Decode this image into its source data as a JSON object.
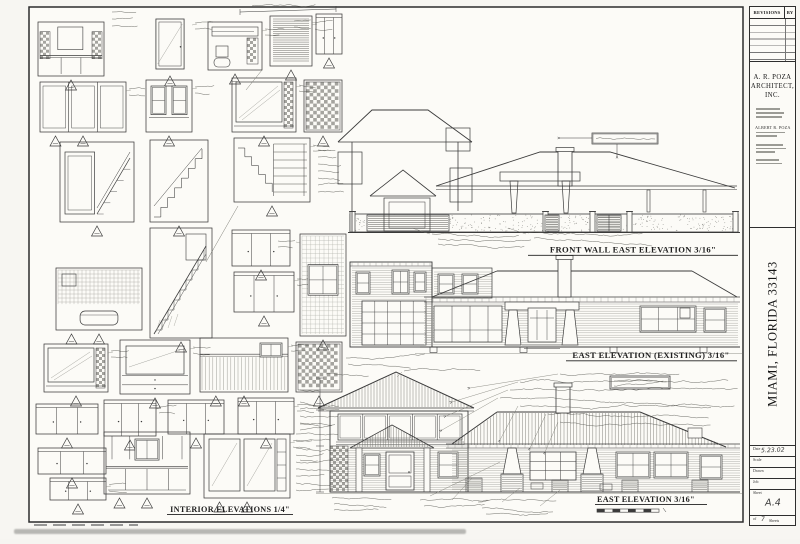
{
  "labels": {
    "front_wall_title": "FRONT WALL EAST ELEVATION 3/16\"",
    "east_existing_title": "EAST ELEVATION (EXISTING) 3/16\"",
    "east_new_title": "EAST ELEVATION 3/16\"",
    "interior_title": "INTERIOR ELEVATIONS 1/4\""
  },
  "title_block": {
    "revisions_label": "REVISIONS",
    "by_label": "BY",
    "firm_line1": "A. R. POZA",
    "firm_line2": "ARCHITECT, INC.",
    "principal": "ALBERT R. POZA",
    "location_vertical": "MIAMI, FLORIDA 33143",
    "date_label": "Date",
    "date_value": "5.23.02",
    "scale_label": "Scale",
    "drawn_label": "Drawn",
    "job_label": "Job",
    "sheet_label": "Sheet",
    "sheet_number": "A.4",
    "of_label": "of",
    "sheet_count": "7",
    "sheets_label": "Sheets"
  },
  "colors": {
    "ink": "#3b3b3b",
    "paper": "#fcfbf7",
    "light_ink": "#8a8a85"
  }
}
